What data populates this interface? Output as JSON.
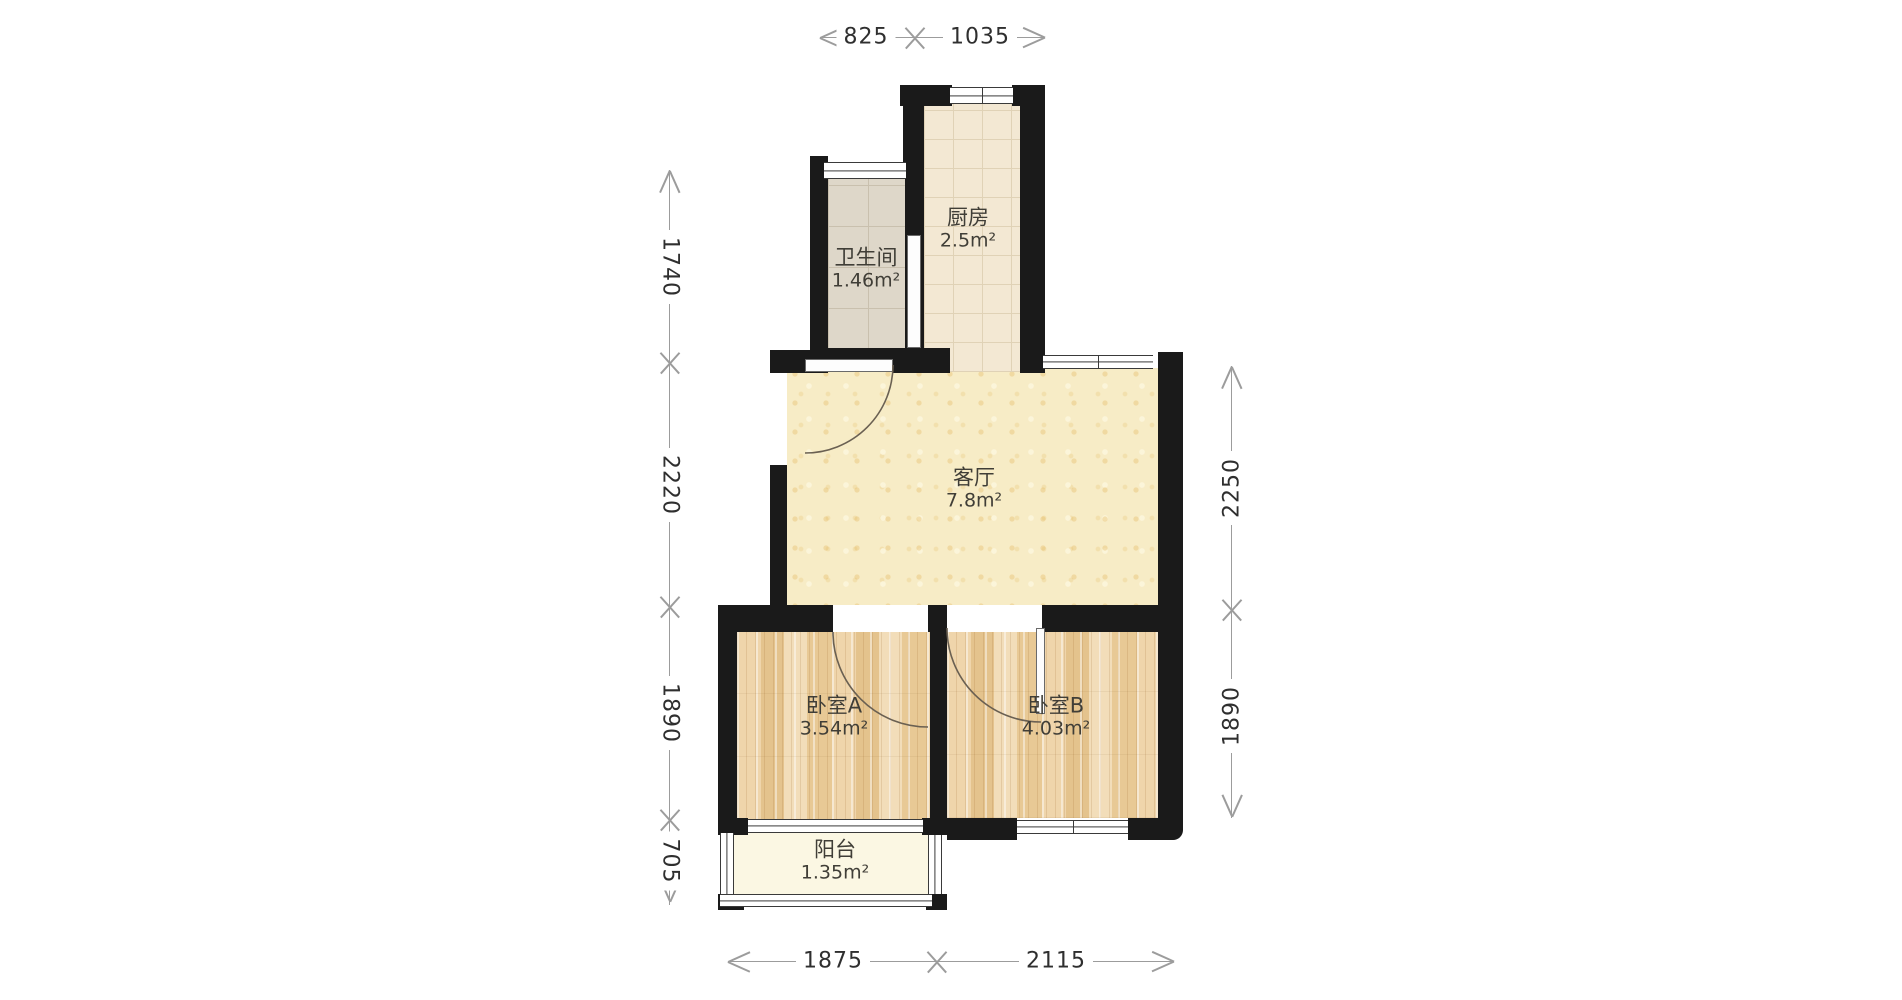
{
  "rooms": {
    "kitchen": {
      "name": "厨房",
      "area": "2.5m²"
    },
    "bathroom": {
      "name": "卫生间",
      "area": "1.46m²"
    },
    "living": {
      "name": "客厅",
      "area": "7.8m²"
    },
    "bedroomA": {
      "name": "卧室A",
      "area": "3.54m²"
    },
    "bedroomB": {
      "name": "卧室B",
      "area": "4.03m²"
    },
    "balcony": {
      "name": "阳台",
      "area": "1.35m²"
    }
  },
  "dimensions": {
    "top": [
      "825",
      "1035"
    ],
    "left": [
      "1740",
      "2220",
      "1890",
      "705"
    ],
    "right": [
      "2250",
      "1890"
    ],
    "bottom": [
      "1875",
      "2115"
    ]
  },
  "colors": {
    "wall": "#1a1a1a",
    "living-base": "#f7ecc6",
    "kitchen-base": "#f3e8d3",
    "bath-base": "#ded7c9",
    "wood-base": "#ecd2a6",
    "balcony-base": "#fbf7e3",
    "dim-line": "#9c9c9c",
    "dim-text": "#2f2f2f",
    "label-text": "#403e37"
  }
}
